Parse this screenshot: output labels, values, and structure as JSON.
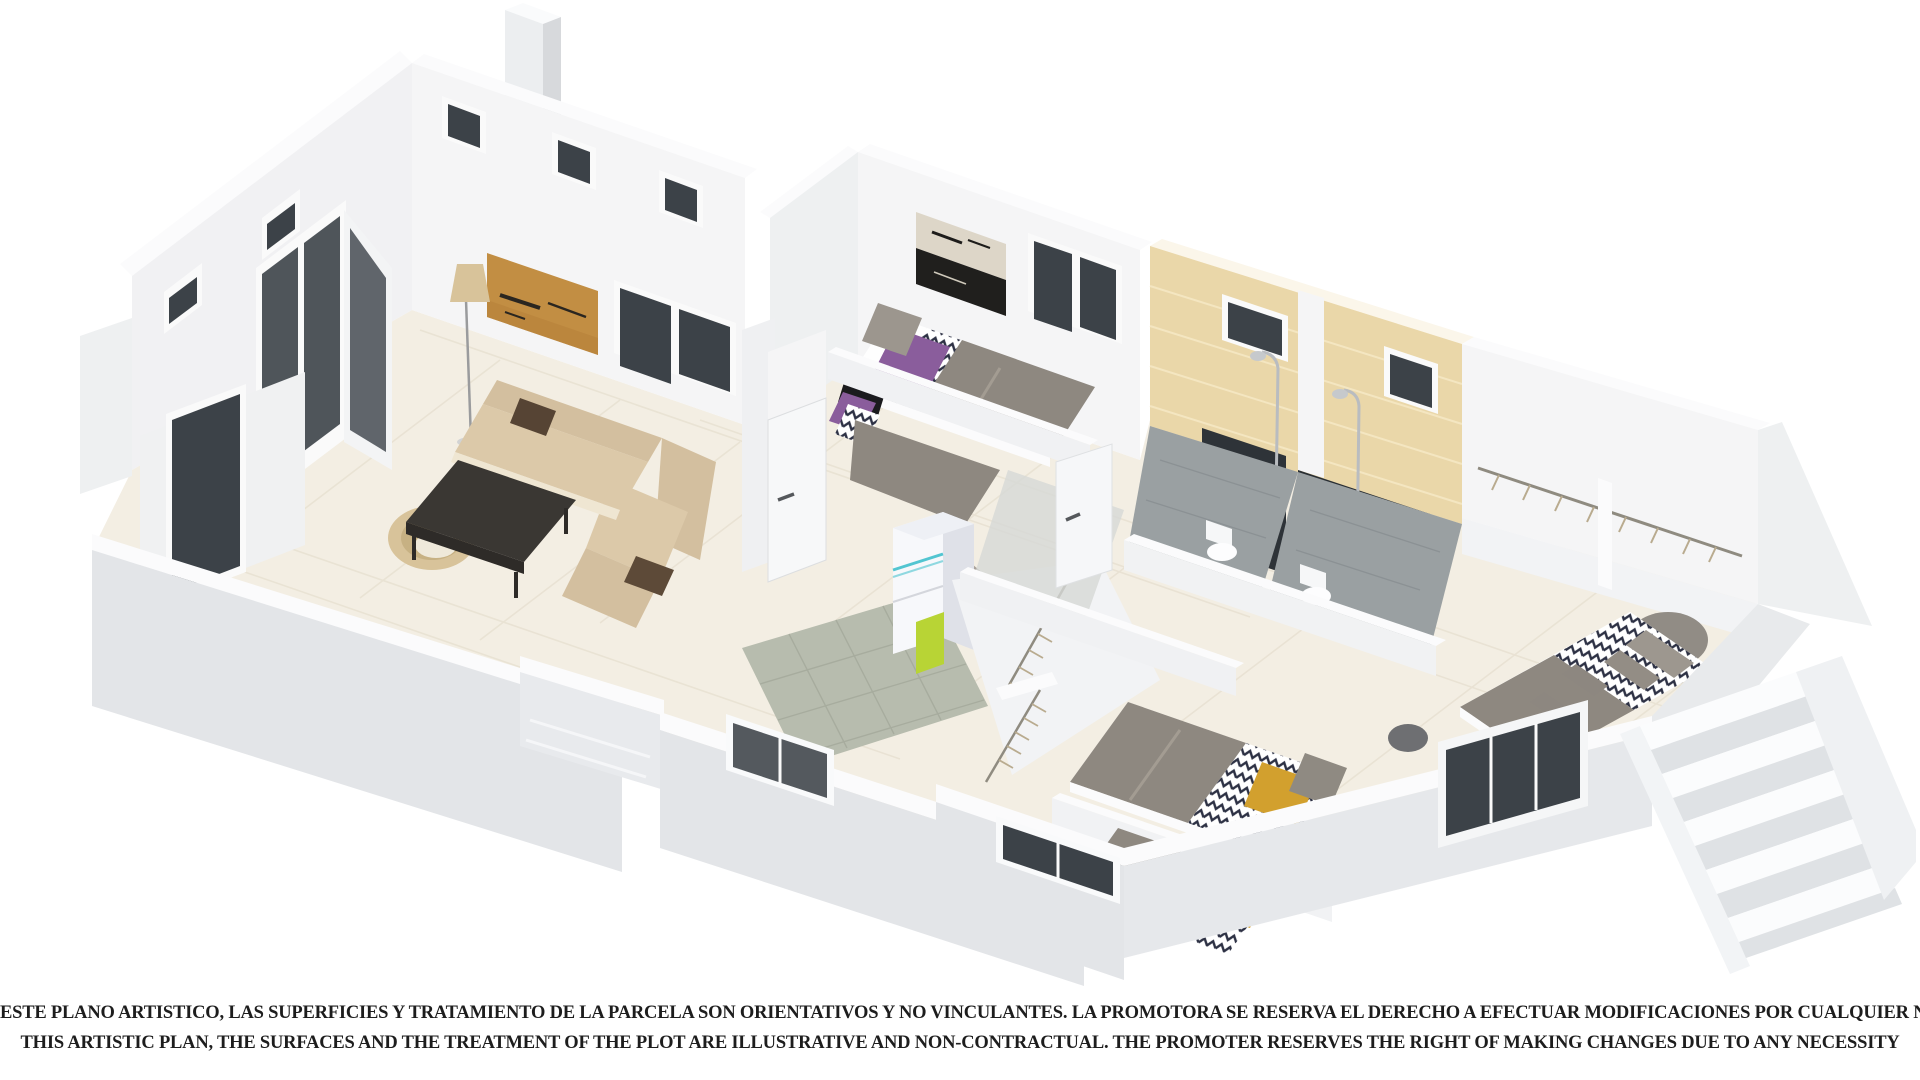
{
  "disclaimer": {
    "line_es": "ESTE PLANO ARTISTICO, LAS SUPERFICIES Y TRATAMIENTO DE LA PARCELA SON ORIENTATIVOS Y NO VINCULANTES. LA PROMOTORA SE RESERVA EL DERECHO A EFECTUAR MODIFICACIONES POR CUALQUIER NECESIDAD",
    "line_en": "THIS ARTISTIC PLAN, THE SURFACES AND THE TREATMENT OF THE PLOT ARE ILLUSTRATIVE AND NON-CONTRACTUAL. THE PROMOTER RESERVES THE RIGHT OF MAKING CHANGES DUE TO ANY NECESSITY"
  },
  "illustration": {
    "type": "3d-isometric-cutaway-floor-plan-render",
    "rooms": [
      "living-room",
      "kitchen",
      "hallway",
      "bedroom-1",
      "bedroom-2",
      "bedroom-3",
      "bedroom-4",
      "master-bedroom",
      "bathroom-1",
      "bathroom-2",
      "walk-in-wardrobe",
      "staircase",
      "entry-porch"
    ],
    "furniture": [
      "corner-sofa",
      "coffee-table",
      "floor-lamp",
      "wall-art",
      "wicker-chair",
      "fridge",
      "kitchen-counter",
      "cooktop",
      "single-beds",
      "double-bed",
      "nightstands",
      "toilets",
      "showers",
      "clothes-rails",
      "chimney"
    ]
  },
  "palette": {
    "bg": "#ffffff",
    "wall-cap": "#fbfbfc",
    "wall-lit": "#f5f5f6",
    "wall-mid": "#eef0f1",
    "wall-outer": "#e3e5e8",
    "wall-dark": "#d7d9dc",
    "floor-cream": "#f3eee3",
    "floor-line": "#e6dfcf",
    "floor-gray": "#9aa0a2",
    "kitchen-floor": "#b7bcae",
    "counter-wood": "#a9a29a",
    "glass-dark": "#3c4248",
    "frame-white": "#fafafa",
    "sofa": "#d3bf9f",
    "sofa-light": "#dcc9a9",
    "cushion-brown": "#564434",
    "table-dark": "#3a3733",
    "bed-gray": "#8e8880",
    "pillow-purple": "#8a5d9c",
    "pillow-mustard": "#d2a02e",
    "chevron-navy": "#2d3144",
    "tile-beige": "#ead7a9",
    "tile-line": "#f4e6c1",
    "lime": "#b8d435",
    "cyan": "#52c5d1",
    "chrome": "#b9bcc0",
    "art-tan": "#c28e43",
    "art-dark": "#2a2620",
    "text-dark": "#1d1d1d"
  }
}
